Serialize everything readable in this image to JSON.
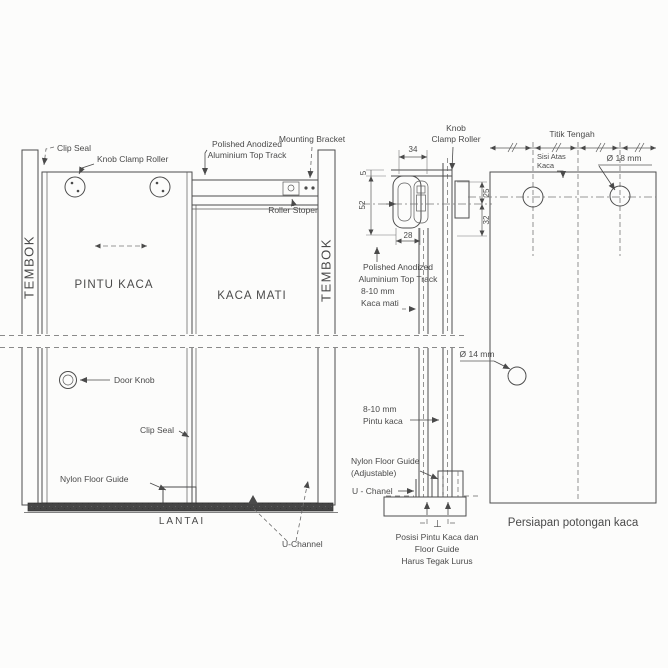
{
  "colors": {
    "ink": "#4d4d4d",
    "paper": "#fcfcfb",
    "floor": "#454545"
  },
  "elevation": {
    "clip_seal_top": "Clip Seal",
    "knob_clamp_roller": "Knob Clamp Roller",
    "top_track_l1": "Polished Anodized",
    "top_track_l2": "Aluminium Top Track",
    "mounting_bracket": "Mounting Bracket",
    "roller_stoper": "Roller Stoper",
    "wall_left": "TEMBOK",
    "wall_right": "TEMBOK",
    "door_panel": "PINTU KACA",
    "fixed_panel": "KACA MATI",
    "door_knob": "Door Knob",
    "clip_seal_bottom": "Clip Seal",
    "nylon_floor_guide": "Nylon Floor Guide",
    "floor": "LANTAI",
    "u_channel": "U-Channel"
  },
  "section": {
    "knob_l1": "Knob",
    "knob_l2": "Clamp Roller",
    "dim_top_width": "34",
    "dim_flange": "5",
    "dim_track_height": "52",
    "dim_bottom_width": "28",
    "dim_upper": "25",
    "dim_lower": "32",
    "track_l1": "Polished Anodized",
    "track_l2": "Aluminium Top Track",
    "fixed_l1": "8-10 mm",
    "fixed_l2": "Kaca mati",
    "door_l1": "8-10 mm",
    "door_l2": "Pintu kaca",
    "guide_l1": "Nylon Floor Guide",
    "guide_l2": "(Adjustable)",
    "u_chanel": "U - Chanel",
    "perp": "⊥",
    "caption_l1": "Posisi Pintu Kaca dan",
    "caption_l2": "Floor Guide",
    "caption_l3": "Harus Tegak Lurus"
  },
  "cutting": {
    "title": "Titik Tengah",
    "top_edge_l1": "Sisi Atas",
    "top_edge_l2": "Kaca",
    "hole_large": "Ø 18 mm",
    "hole_small": "Ø 14 mm",
    "caption": "Persiapan potongan kaca"
  }
}
